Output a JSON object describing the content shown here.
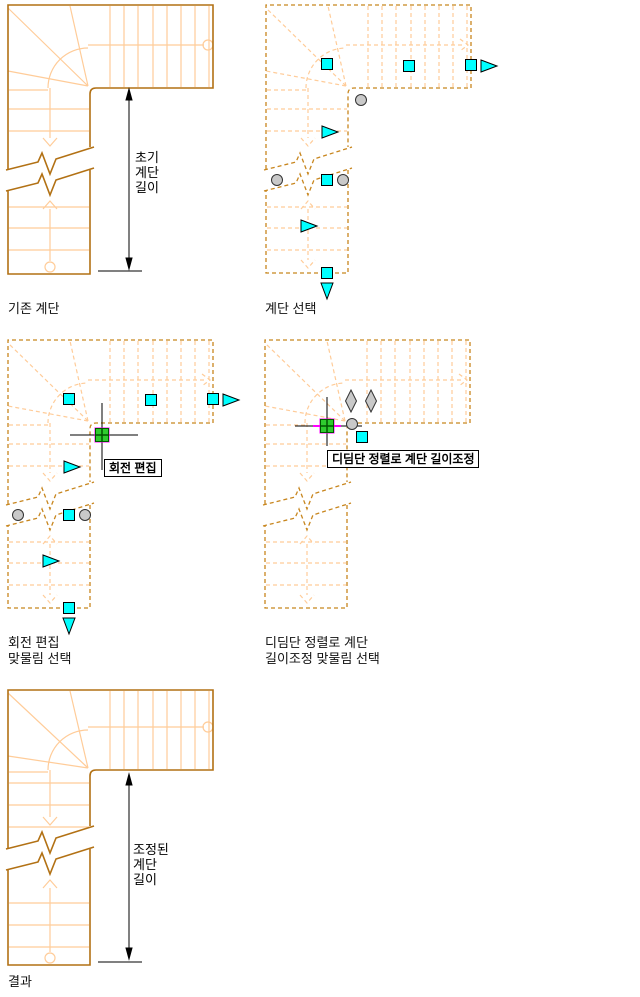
{
  "colors": {
    "stair_solid": "#B27114",
    "stair_dashed": "#C8861E",
    "stair_light": "#FFCC99",
    "grip_cyan": "#00FFFF",
    "grip_gray": "#C9C9C9",
    "grip_selected_green": "#2FCC2F",
    "grip_selected_dark": "#005500",
    "rubber_band_magenta": "#FF00FF",
    "dimension_color": "#000000",
    "text_color": "#111111"
  },
  "diagrams": [
    {
      "name": "existing-stair",
      "caption_lines": [
        "기존 계단"
      ],
      "dimension_lines": [
        "초기",
        "계단",
        "길이"
      ]
    },
    {
      "name": "stair-selected",
      "caption_lines": [
        "계단 선택"
      ]
    },
    {
      "name": "rotate-edit-grip",
      "caption_lines": [
        "회전 편집",
        "맞물림 선택"
      ],
      "grip_tooltip": "회전 편집"
    },
    {
      "name": "tread-align-grip",
      "caption_lines": [
        "디딤단 정렬로 계단",
        "길이조정 맞물림 선택"
      ],
      "grip_tooltip": "디딤단 정렬로 계단 길이조정"
    },
    {
      "name": "result-stair",
      "caption_lines": [
        "결과"
      ],
      "dimension_lines": [
        "조정된",
        "계단",
        "길이"
      ]
    }
  ]
}
